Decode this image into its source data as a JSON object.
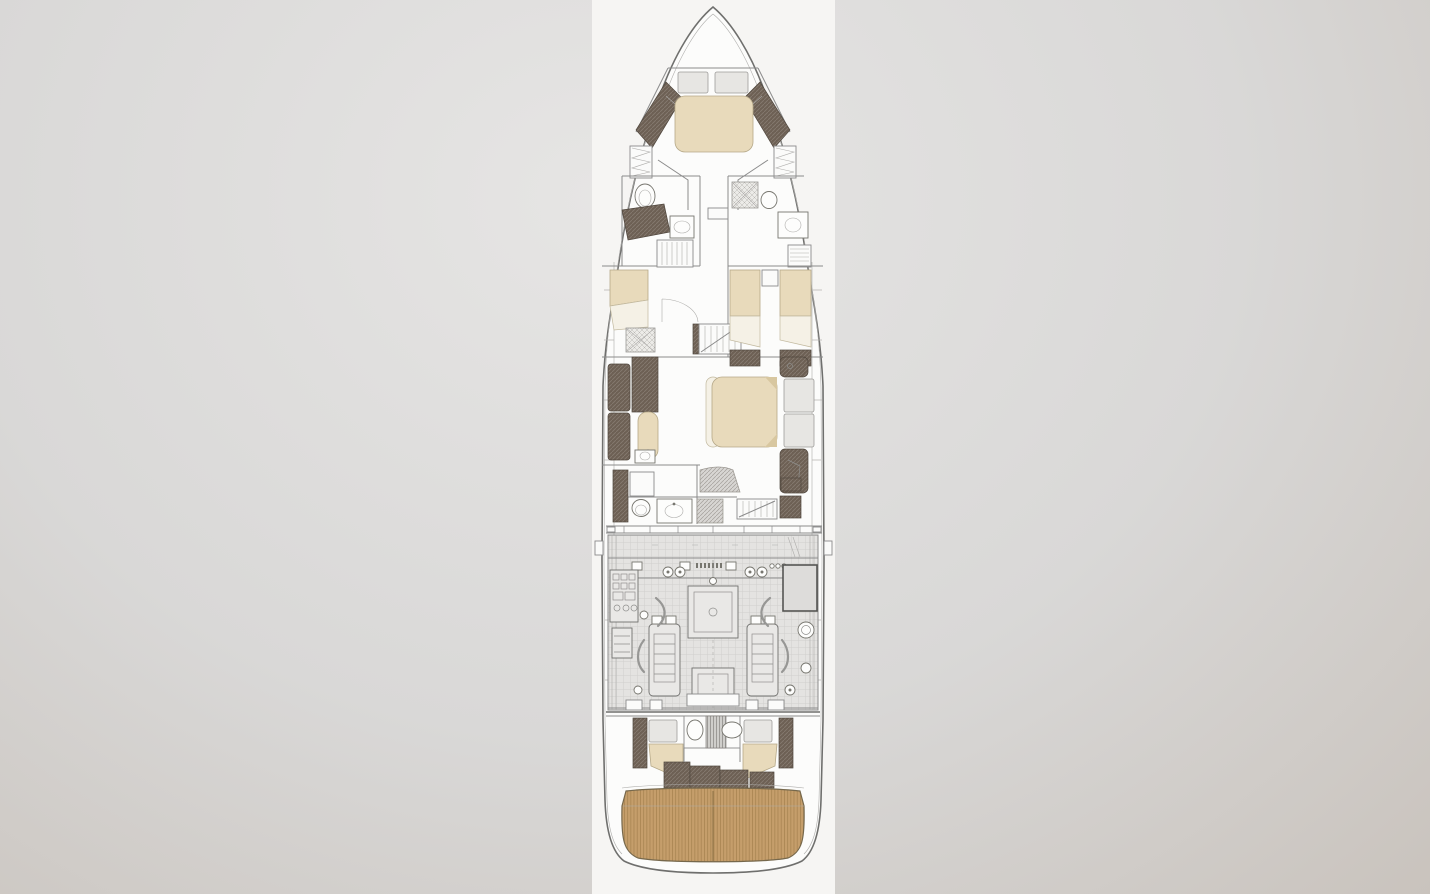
{
  "meta": {
    "kind": "yacht-lower-deck-floorplan",
    "orientation": "bow-up"
  },
  "colors": {
    "bg-grad-1": "#e6e5e4",
    "bg-grad-2": "#d9d8d7",
    "bg-grad-3": "#c9c3bd",
    "strip-bg": "#f6f5f3",
    "hull-fill": "#fcfcfb",
    "line": "#8b8b8b",
    "line-strong": "#6f6f6d",
    "bed-beige": "#e8dabb",
    "bed-white": "#f5f1e6",
    "pillow-gray": "#e7e6e3",
    "dark-wood": "#6d6054",
    "wood-deck": "#c59e6b",
    "wood-line": "#a5814e",
    "shower-bg": "#ecebe8",
    "engine-bg": "#e4e3e1"
  },
  "features": [
    "bow-vip-cabin-double-bed",
    "port-bathroom-toilet-vanity",
    "starboard-bathroom-shower-toilet",
    "port-single-guest-cabin",
    "starboard-twin-guest-cabin",
    "central-staircase",
    "midship-master-cabin-double-bed",
    "master-sofa-and-chaise",
    "master-bathroom",
    "lower-staircase",
    "engine-room-twin-engines",
    "crew-cabin-two-berths",
    "crew-bathroom",
    "teak-swim-platform"
  ]
}
